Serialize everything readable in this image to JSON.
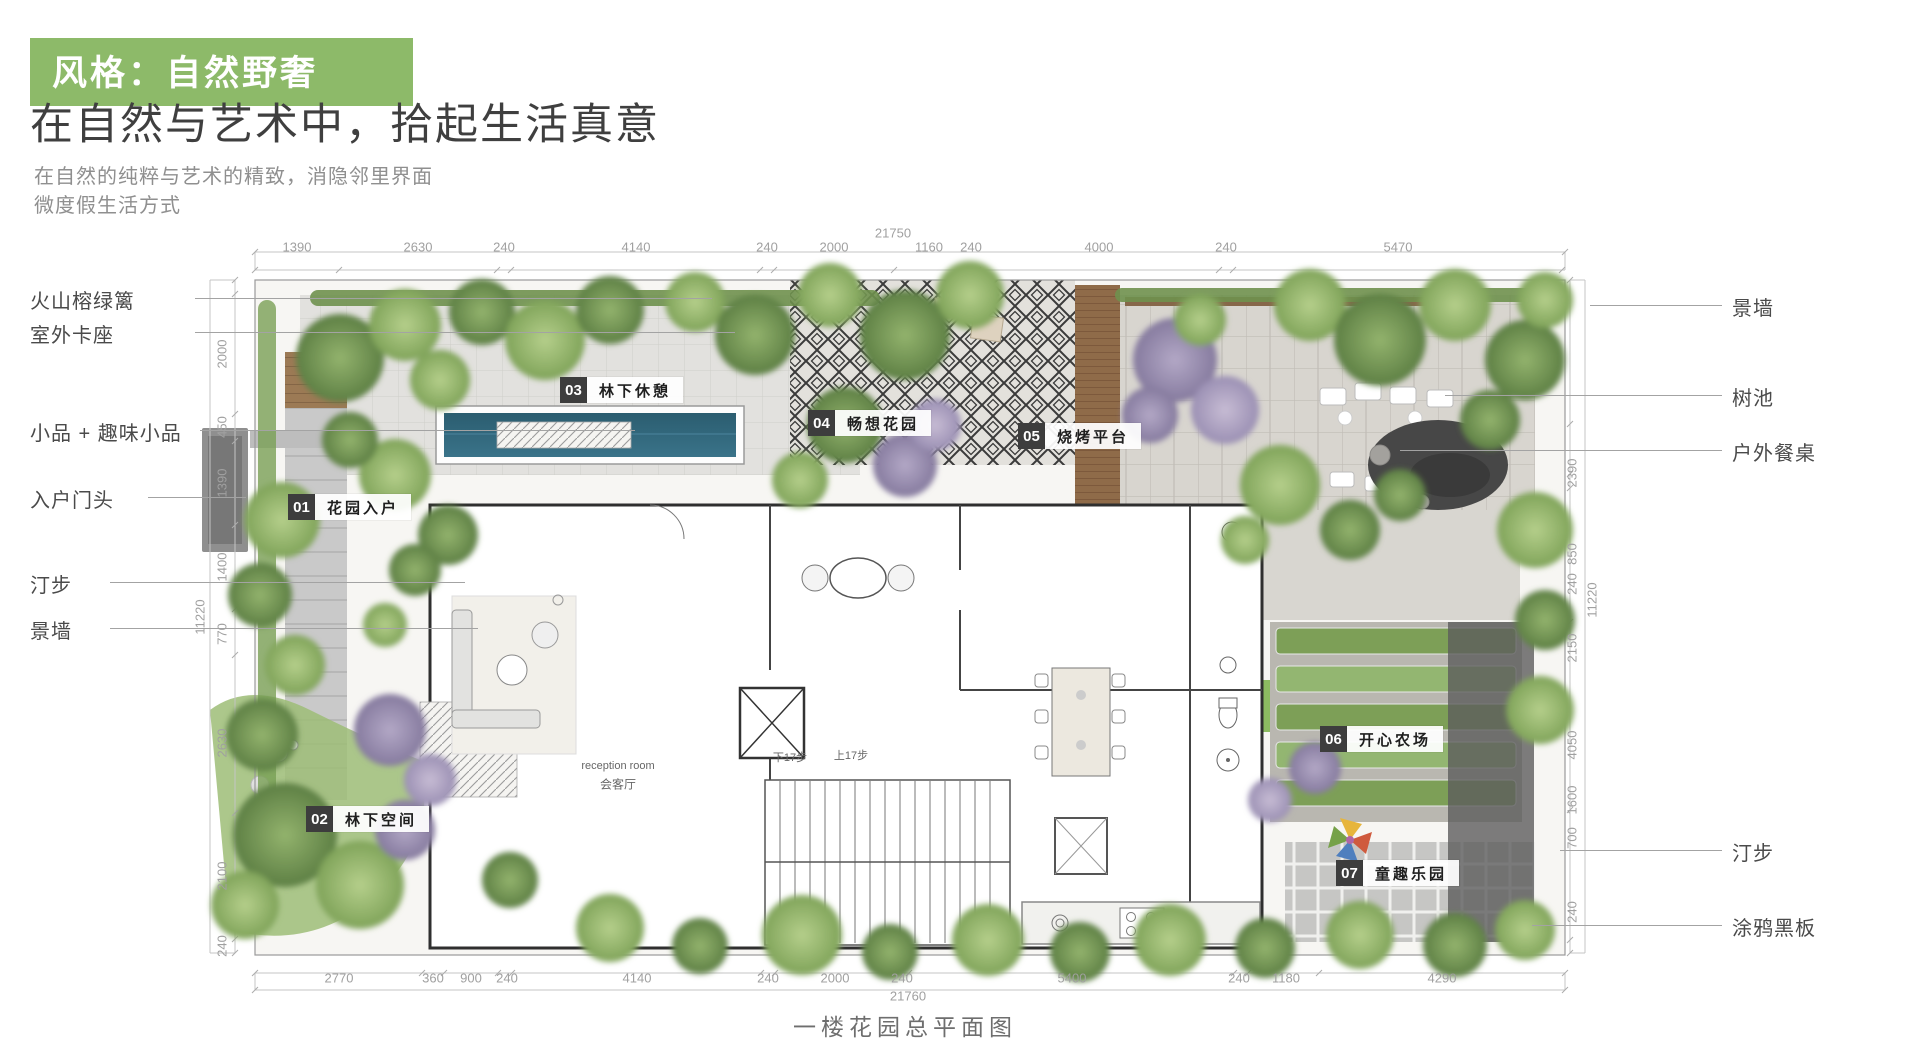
{
  "header": {
    "badge": "风格：自然野奢",
    "title": "在自然与艺术中，拾起生活真意",
    "subtitle_line1": "在自然的纯粹与艺术的精致，消隐邻里界面",
    "subtitle_line2": "微度假生活方式"
  },
  "colors": {
    "accent_green": "#8dba69",
    "badge_dark": "#3d3d3d",
    "pool_water": "#31657a",
    "foliage_green": "#7fa359",
    "flower_purple": "#9a8fb3"
  },
  "plan": {
    "caption": "一楼花园总平面图",
    "callouts_left": [
      {
        "label": "火山榕绿篱"
      },
      {
        "label": "室外卡座"
      },
      {
        "label": "小品 + 趣味小品"
      },
      {
        "label": "入户门头"
      },
      {
        "label": "汀步"
      },
      {
        "label": "景墙"
      }
    ],
    "callouts_right": [
      {
        "label": "景墙"
      },
      {
        "label": "树池"
      },
      {
        "label": "户外餐桌"
      },
      {
        "label": "汀步"
      },
      {
        "label": "涂鸦黑板"
      }
    ],
    "zones": [
      {
        "num": "01",
        "name": "花园入户"
      },
      {
        "num": "02",
        "name": "林下空间"
      },
      {
        "num": "03",
        "name": "林下休憩"
      },
      {
        "num": "04",
        "name": "畅想花园"
      },
      {
        "num": "05",
        "name": "烧烤平台"
      },
      {
        "num": "06",
        "name": "开心农场"
      },
      {
        "num": "07",
        "name": "童趣乐园"
      }
    ],
    "interior_labels": {
      "reception_en": "reception room",
      "reception_cn": "会客厅",
      "stairs_down": "下17步",
      "stairs_up": "上17步"
    },
    "dims": {
      "top_total": "21750",
      "top": [
        "1390",
        "2630",
        "240",
        "4140",
        "240",
        "2000",
        "1160",
        "240",
        "4000",
        "240",
        "5470"
      ],
      "bottom": [
        "2770",
        "360",
        "900",
        "240",
        "4140",
        "240",
        "2000",
        "240",
        "5400",
        "240",
        "1180",
        "4290"
      ],
      "bottom_total": "21760",
      "left_total": "11220",
      "left": [
        "2000",
        "450",
        "1390",
        "1400",
        "770",
        "2630",
        "2100",
        "240"
      ],
      "right": [
        "2390",
        "850",
        "240",
        "2150",
        "4050",
        "1600",
        "700",
        "240"
      ],
      "right_total": "11220"
    }
  }
}
